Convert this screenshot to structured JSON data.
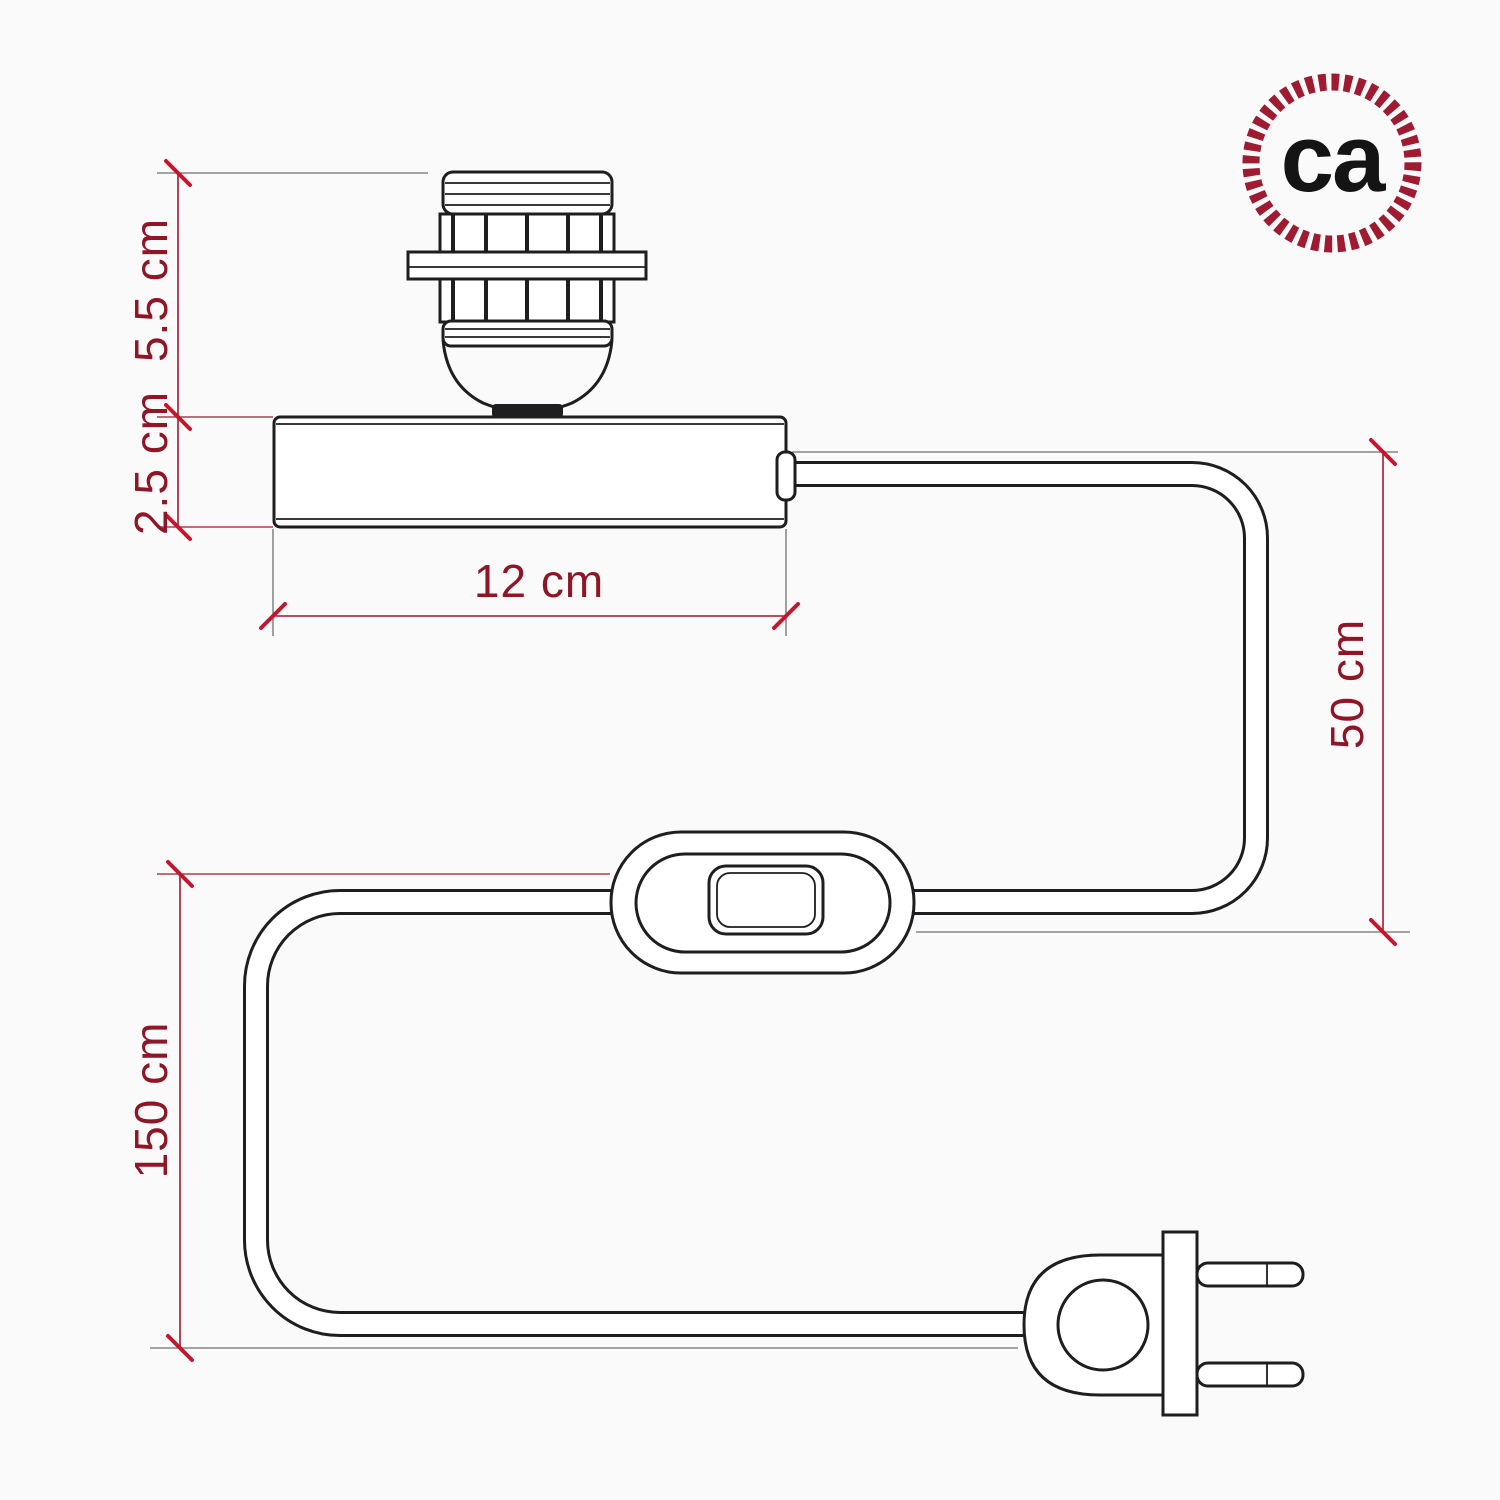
{
  "theme": {
    "background": "#fafafa",
    "line_color": "#1e1e20",
    "dim_line_color": "#a0182e",
    "dim_text_color": "#8e1626",
    "tick_color": "#c2172e",
    "extension_line_color": "#6f6f6f",
    "logo_rope_color": "#9e1b32",
    "logo_text_color": "#141414"
  },
  "logo": {
    "text": "ca"
  },
  "dimensions": {
    "socket_height": "5.5 cm",
    "base_height": "2.5 cm",
    "base_width": "12 cm",
    "upper_cable": "50 cm",
    "lower_cable": "150 cm"
  }
}
